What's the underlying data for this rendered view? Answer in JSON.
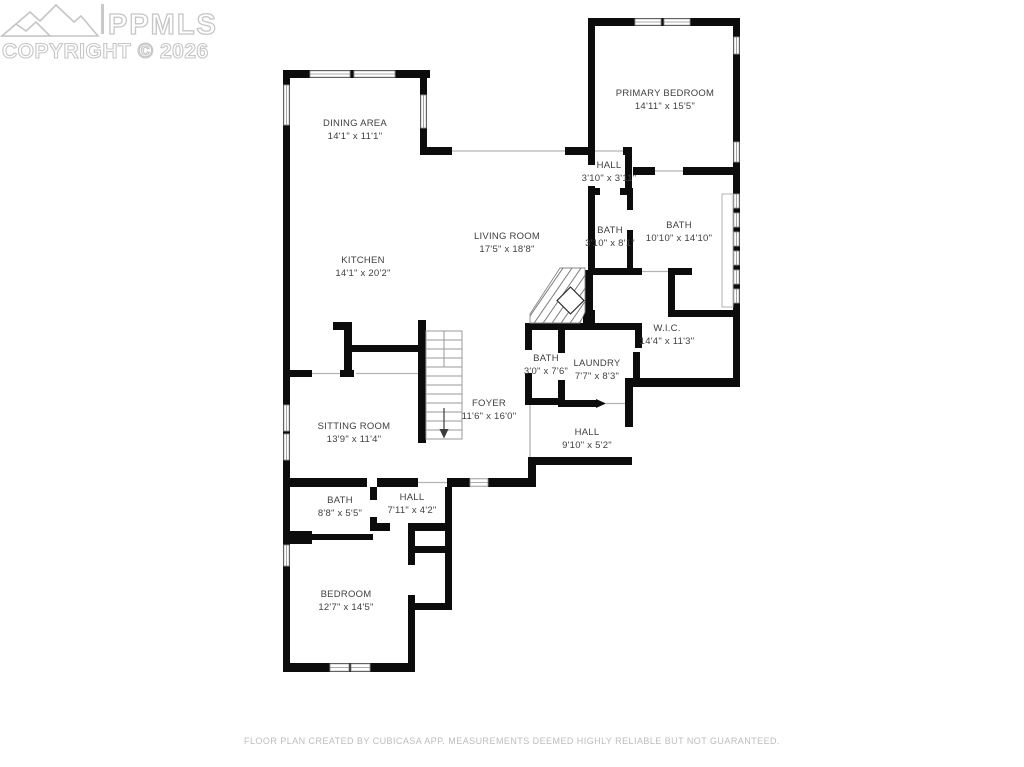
{
  "watermark": {
    "brand": "PPMLS",
    "copyright": "COPYRIGHT © 2026",
    "logo_icon": "mountain-range-icon"
  },
  "colors": {
    "wall": "#0c0c0c",
    "room_label": "#3f3f3f",
    "watermark_gray": "#c6c6c6",
    "disclaimer_gray": "#bcbcbc",
    "background": "#ffffff"
  },
  "rooms": [
    {
      "name": "DINING AREA",
      "dims": "14'1\" x 11'1\""
    },
    {
      "name": "PRIMARY BEDROOM",
      "dims": "14'11\" x 15'5\""
    },
    {
      "name": "HALL",
      "dims": "3'10\" x 3'11\""
    },
    {
      "name": "LIVING ROOM",
      "dims": "17'5\" x 18'8\""
    },
    {
      "name": "BATH",
      "dims": "3'10\" x 8'1\""
    },
    {
      "name": "BATH",
      "dims": "10'10\" x 14'10\""
    },
    {
      "name": "KITCHEN",
      "dims": "14'1\" x 20'2\""
    },
    {
      "name": "W.I.C.",
      "dims": "14'4\" x 11'3\""
    },
    {
      "name": "BATH",
      "dims": "3'0\" x 7'6\""
    },
    {
      "name": "LAUNDRY",
      "dims": "7'7\" x 8'3\""
    },
    {
      "name": "FOYER",
      "dims": "11'6\" x 16'0\""
    },
    {
      "name": "SITTING ROOM",
      "dims": "13'9\" x 11'4\""
    },
    {
      "name": "HALL",
      "dims": "9'10\" x 5'2\""
    },
    {
      "name": "BATH",
      "dims": "8'8\" x 5'5\""
    },
    {
      "name": "HALL",
      "dims": "7'11\" x 4'2\""
    },
    {
      "name": "BEDROOM",
      "dims": "12'7\" x 14'5\""
    }
  ],
  "footer": {
    "disclaimer": "FLOOR PLAN CREATED BY CUBICASA APP. MEASUREMENTS DEEMED HIGHLY RELIABLE BUT NOT GUARANTEED."
  }
}
